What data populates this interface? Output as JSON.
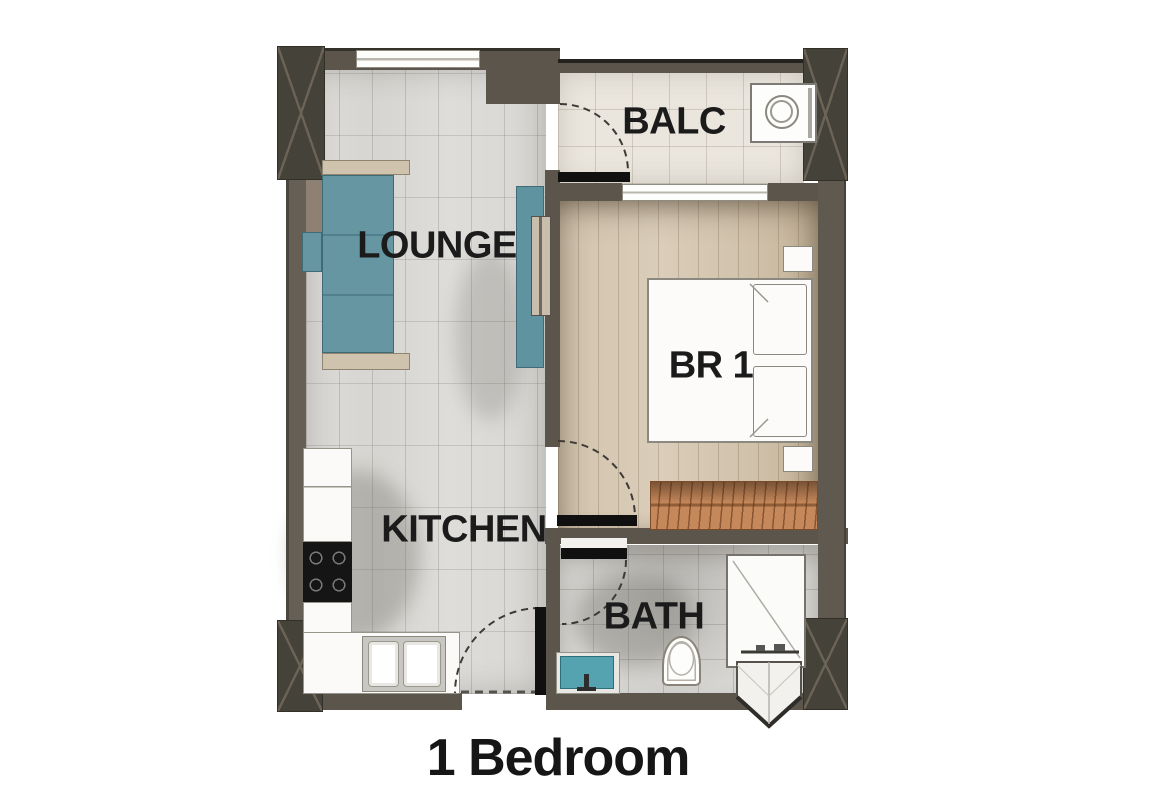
{
  "title": "1 Bedroom",
  "rooms": {
    "lounge": {
      "label": "LOUNGE"
    },
    "balcony": {
      "label": "BALC"
    },
    "bedroom": {
      "label": "BR 1"
    },
    "kitchen": {
      "label": "KITCHEN"
    },
    "bath": {
      "label": "BATH"
    }
  },
  "palette": {
    "wall": "#5b554c",
    "column": "#45423a",
    "sofa_teal": "#6596a2",
    "tv_console_teal": "#5f93a0",
    "wardrobe_orange": "#c5885a",
    "bath_sink_teal": "#55a2b0",
    "tile_floor": "#dcdbd7",
    "balcony_tile": "#eae6de",
    "wood_floor": "#d6c9b5",
    "bath_tile": "#d4d3d0",
    "door_leaf": "#101010",
    "label_color": "#1b1b1b"
  }
}
